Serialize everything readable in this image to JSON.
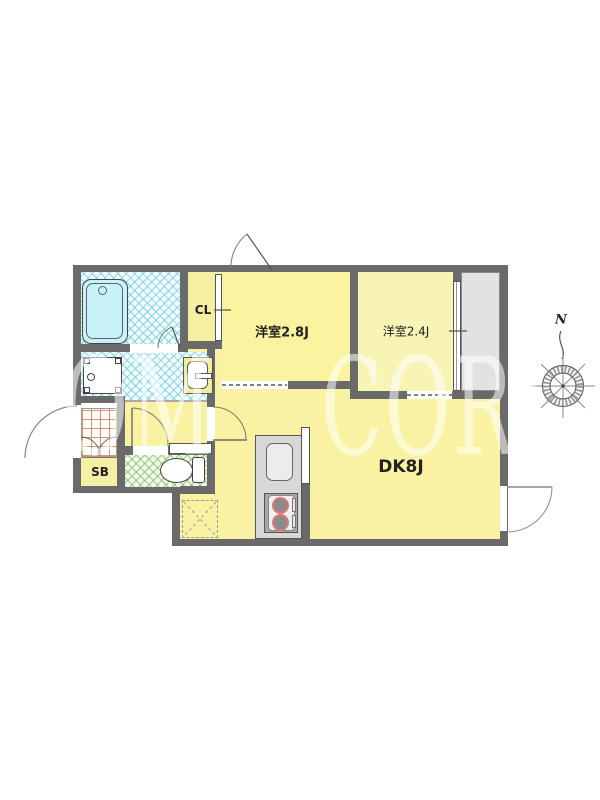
{
  "floorplan": {
    "type": "japanese-apartment-floor-plan",
    "rooms": [
      {
        "id": "closet",
        "label": "CL"
      },
      {
        "id": "western-room-1",
        "label": "洋室2.8J"
      },
      {
        "id": "western-room-2",
        "label": "洋室2.4J"
      },
      {
        "id": "dining-kitchen",
        "label": "DK8J"
      },
      {
        "id": "shoe-box",
        "label": "SB"
      }
    ],
    "fixtures": [
      "bathtub",
      "washing-machine-pan",
      "wash-basin",
      "toilet",
      "kitchen-counter",
      "kitchen-sink",
      "gas-stove-two-burners",
      "refrigerator-space",
      "entrance-tile",
      "balcony"
    ],
    "compass": {
      "north_label": "N"
    },
    "watermark": {
      "part1": "OM",
      "part2": "CORI"
    },
    "colors": {
      "wall": "#6a6a6a",
      "floor_yellow": "#f9f2a2",
      "room28_yellow": "#faf3a0",
      "room24_yellow": "#f8f4b6",
      "bath_hatch": "#6ecde1",
      "toilet_hatch": "#7dbe5f",
      "entrance_grid": "#c87350",
      "balcony_gray": "#e2e2e2",
      "counter_gray": "#d8d8d8",
      "burner_red": "#dd7777",
      "watermark_white": "rgba(255,255,255,0.55)"
    }
  }
}
